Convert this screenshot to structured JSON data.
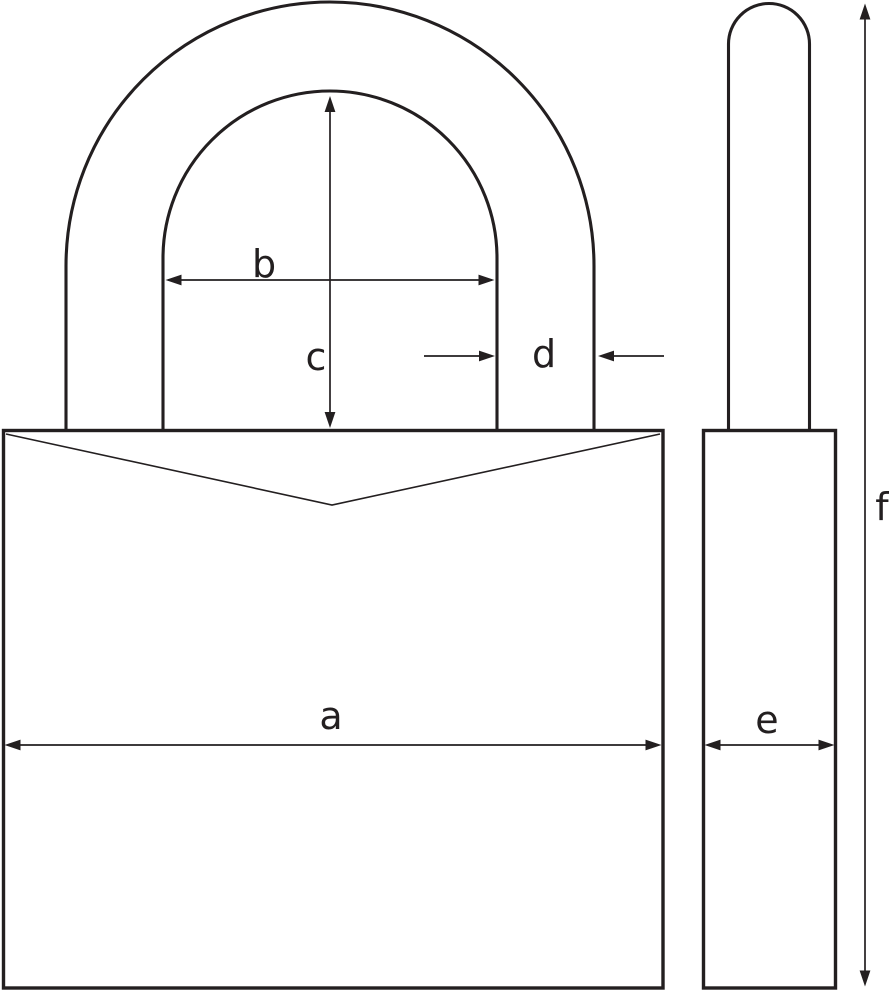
{
  "diagram": {
    "type": "technical-dimension-drawing",
    "subject": "padlock",
    "background_color": "#ffffff",
    "line_color": "#231f20",
    "dimension_labels": {
      "a": "a",
      "b": "b",
      "c": "c",
      "d": "d",
      "e": "e",
      "f": "f"
    }
  }
}
